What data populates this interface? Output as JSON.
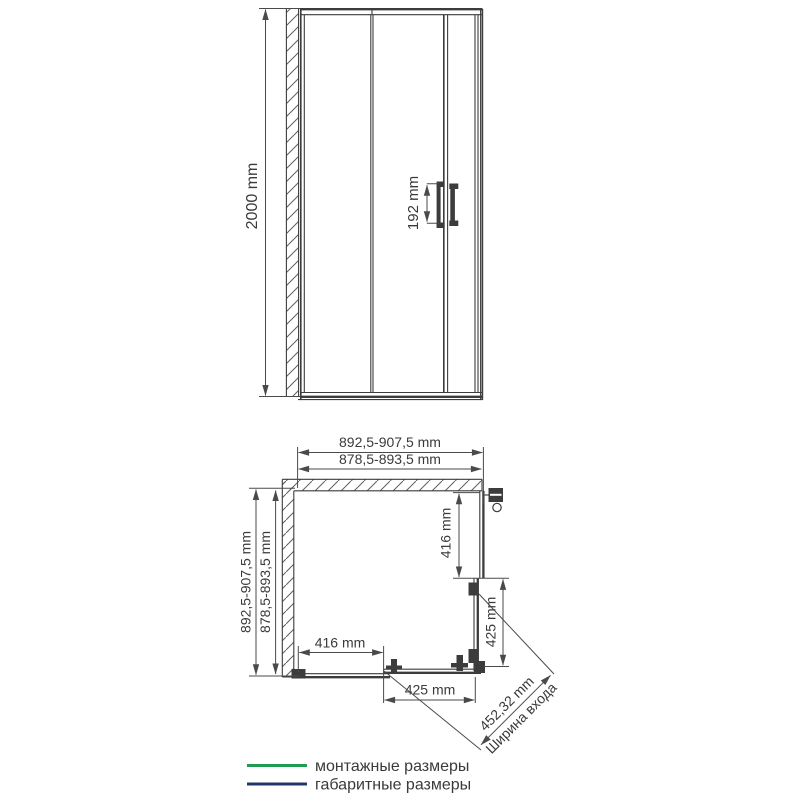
{
  "colors": {
    "drawing": "#3c3c3c",
    "dimension": "#4a4a4a",
    "text": "#3a3a3a",
    "green": "#1f9b52",
    "navy": "#1f3a68"
  },
  "front_view": {
    "height": "2000 mm",
    "handle_width": "192 mm"
  },
  "plan_view": {
    "width_overall": "892,5-907,5 mm",
    "width_mounting": "878,5-893,5 mm",
    "depth_overall": "892,5-907,5 mm",
    "depth_mounting": "878,5-893,5 mm",
    "right_fixed_panel": "416 mm",
    "right_door": "425 mm",
    "bottom_fixed_panel": "416 mm",
    "bottom_door": "425 mm",
    "entrance_width": "452,32 mm",
    "entrance_label": "Ширина входа"
  },
  "legend": {
    "mounting_label": "монтажные размеры",
    "mounting_color": "#1f9b52",
    "overall_label": "габаритные размеры",
    "overall_color": "#1f3a68"
  }
}
